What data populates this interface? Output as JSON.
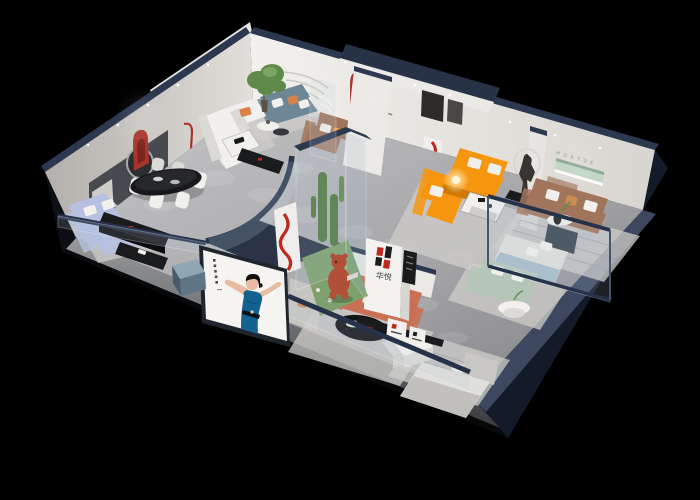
{
  "scene": {
    "description": "Isometric night-time 3D cutaway render of a furniture brand showroom with multiple room vignettes",
    "background": "#000000"
  },
  "branding": {
    "logo_characters": "华悦",
    "wall_letters": "H U A Y U E",
    "logo_red": "#c0281e",
    "logo_dark": "#1d1d1f"
  },
  "palette": {
    "shell_navy": "#2d3952",
    "shell_navy_dark": "#131a28",
    "wall_white": "#efede9",
    "floor_light": "#bcbcbe",
    "floor_dark": "#85868a",
    "accent_red": "#a8352c",
    "sofa_orange": "#f6960f",
    "sofa_periwinkle": "#b6c0e0",
    "sofa_teal": "#6e8796",
    "sofa_mint": "#b5c6b8",
    "sofa_salmon": "#c96f52",
    "sofa_brown": "#a1755c",
    "armchair_caramel": "#c98d52",
    "bed_gray": "#e0dfdc",
    "dress_blue": "#15618f",
    "plant_green": "#5e8b4a",
    "niche_green": "#c2d6c4",
    "sculpture_terracotta": "#b14f38"
  }
}
